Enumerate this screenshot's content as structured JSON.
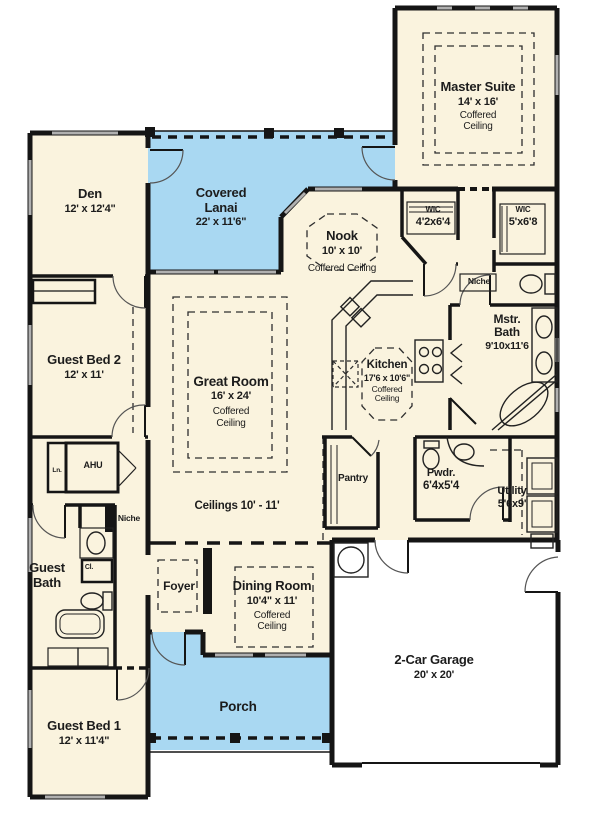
{
  "plan": {
    "colors": {
      "interior": "#FAF3DE",
      "outdoor_blue": "#A9D8F2",
      "garage_white": "#FFFFFF",
      "wall": "#151515",
      "window_gray": "#B0B0B0",
      "text": "#1C1C1C"
    },
    "rooms": {
      "master_suite": {
        "name": "Master Suite",
        "dims": "14' x 16'",
        "note": "Coffered Ceiling"
      },
      "den": {
        "name": "Den",
        "dims": "12' x 12'4\""
      },
      "covered_lanai": {
        "name": "Covered Lanai",
        "dims": "22' x 11'6\""
      },
      "nook": {
        "name": "Nook",
        "dims": "10' x 10'",
        "note": "Coffered Ceiling"
      },
      "wic_1": {
        "name": "WIC",
        "dims": "4'2x6'4"
      },
      "wic_2": {
        "name": "WIC",
        "dims": "5'x6'8"
      },
      "niche_master": {
        "name": "Niche"
      },
      "mstr_bath": {
        "name": "Mstr. Bath",
        "dims": "9'10x11'6"
      },
      "guest_bed_2": {
        "name": "Guest Bed 2",
        "dims": "12' x 11'"
      },
      "great_room": {
        "name": "Great Room",
        "dims": "16' x 24'",
        "note": "Coffered Ceiling"
      },
      "kitchen": {
        "name": "Kitchen",
        "dims": "17'6 x 10'6\"",
        "note": "Coffered Ceiling"
      },
      "pantry": {
        "name": "Pantry"
      },
      "pwdr": {
        "name": "Pwdr.",
        "dims": "6'4x5'4"
      },
      "utility": {
        "name": "Utility",
        "dims": "5'6x9'"
      },
      "ahu": {
        "name": "AHU"
      },
      "linen": {
        "name": "Ln."
      },
      "niche_hall": {
        "name": "Niche"
      },
      "guest_bath": {
        "name": "Guest Bath"
      },
      "closet": {
        "name": "Cl."
      },
      "ceilings_note": {
        "name": "Ceilings 10' - 11'"
      },
      "foyer": {
        "name": "Foyer"
      },
      "dining_room": {
        "name": "Dining Room",
        "dims": "10'4\" x 11'",
        "note": "Coffered Ceiling"
      },
      "porch": {
        "name": "Porch"
      },
      "garage": {
        "name": "2-Car Garage",
        "dims": "20' x 20'"
      },
      "guest_bed_1": {
        "name": "Guest Bed 1",
        "dims": "12' x 11'4\""
      }
    }
  }
}
